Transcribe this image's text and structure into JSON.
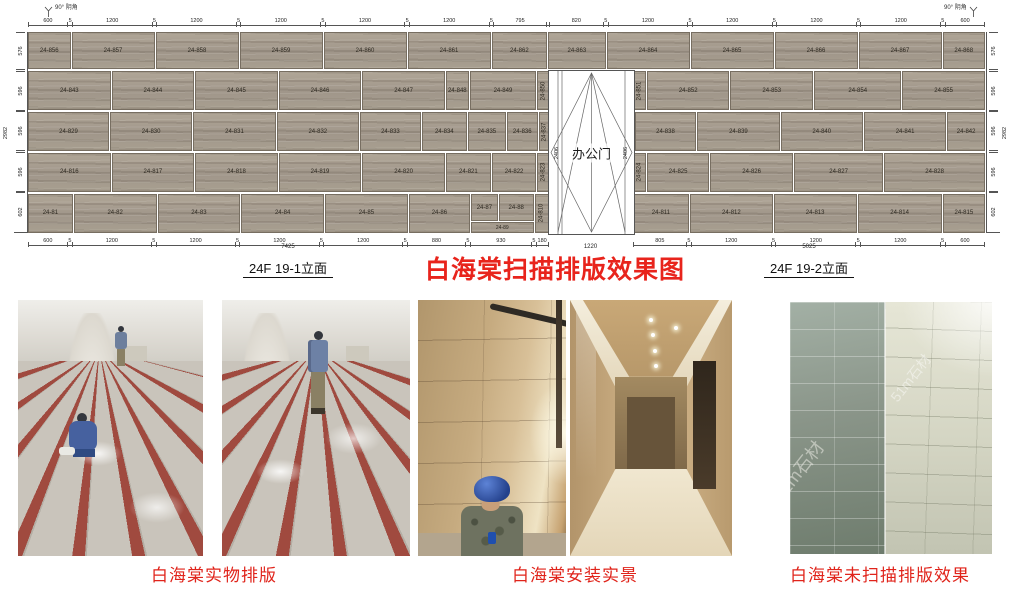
{
  "colors": {
    "accent_red": "#e8241c",
    "stone": "#a89e90"
  },
  "elevation": {
    "corner_note_left": "90° 阴角",
    "corner_note_right": "90° 阴角",
    "main_title": "白海棠扫描排版效果图",
    "label_left": "24F 19-1立面",
    "label_right": "24F 19-2立面",
    "total_left": "7425",
    "total_door": "1220",
    "total_right": "5025",
    "door": {
      "label": "办公门",
      "height_dim": "2406"
    },
    "top_dims": [
      {
        "v": "600",
        "w": 600
      },
      {
        "v": "5",
        "w": 70
      },
      {
        "v": "1200",
        "w": 1200
      },
      {
        "v": "5",
        "w": 70
      },
      {
        "v": "1200",
        "w": 1200
      },
      {
        "v": "5",
        "w": 70
      },
      {
        "v": "1200",
        "w": 1200
      },
      {
        "v": "5",
        "w": 70
      },
      {
        "v": "1200",
        "w": 1200
      },
      {
        "v": "5",
        "w": 70
      },
      {
        "v": "1200",
        "w": 1200
      },
      {
        "v": "5",
        "w": 70
      },
      {
        "v": "795",
        "w": 795
      },
      {
        "v": "",
        "w": 40
      },
      {
        "v": "820",
        "w": 820
      },
      {
        "v": "5",
        "w": 70
      },
      {
        "v": "1200",
        "w": 1200
      },
      {
        "v": "5",
        "w": 70
      },
      {
        "v": "1200",
        "w": 1200
      },
      {
        "v": "5",
        "w": 70
      },
      {
        "v": "1200",
        "w": 1200
      },
      {
        "v": "5",
        "w": 70
      },
      {
        "v": "1200",
        "w": 1200
      },
      {
        "v": "5",
        "w": 70
      },
      {
        "v": "600",
        "w": 600
      }
    ],
    "bottom_dims_left": [
      {
        "v": "600",
        "w": 600
      },
      {
        "v": "5",
        "w": 70
      },
      {
        "v": "1200",
        "w": 1200
      },
      {
        "v": "5",
        "w": 70
      },
      {
        "v": "1200",
        "w": 1200
      },
      {
        "v": "5",
        "w": 70
      },
      {
        "v": "1200",
        "w": 1200
      },
      {
        "v": "5",
        "w": 70
      },
      {
        "v": "1200",
        "w": 1200
      },
      {
        "v": "5",
        "w": 70
      },
      {
        "v": "880",
        "w": 880
      },
      {
        "v": "5",
        "w": 70
      },
      {
        "v": "930",
        "w": 930
      },
      {
        "v": "5",
        "w": 70
      },
      {
        "v": "180",
        "w": 180
      }
    ],
    "bottom_dims_right": [
      {
        "v": "805",
        "w": 805
      },
      {
        "v": "5",
        "w": 70
      },
      {
        "v": "1200",
        "w": 1200
      },
      {
        "v": "5",
        "w": 70
      },
      {
        "v": "1200",
        "w": 1200
      },
      {
        "v": "5",
        "w": 70
      },
      {
        "v": "1200",
        "w": 1200
      },
      {
        "v": "5",
        "w": 70
      },
      {
        "v": "600",
        "w": 600
      }
    ],
    "left_dims": {
      "total": "2982",
      "segments": [
        {
          "v": "576",
          "w": 576
        },
        {
          "v": "4",
          "w": 20
        },
        {
          "v": "596",
          "w": 596
        },
        {
          "v": "4",
          "w": 20
        },
        {
          "v": "596",
          "w": 596
        },
        {
          "v": "4",
          "w": 20
        },
        {
          "v": "596",
          "w": 596
        },
        {
          "v": "4",
          "w": 20
        },
        {
          "v": "602",
          "w": 602
        }
      ]
    },
    "right_dims": {
      "total": "2982",
      "segments": [
        {
          "v": "576",
          "w": 576
        },
        {
          "v": "4",
          "w": 20
        },
        {
          "v": "596",
          "w": 596
        },
        {
          "v": "4",
          "w": 20
        },
        {
          "v": "596",
          "w": 596
        },
        {
          "v": "4",
          "w": 20
        },
        {
          "v": "596",
          "w": 596
        },
        {
          "v": "4",
          "w": 20
        },
        {
          "v": "602",
          "w": 602
        }
      ]
    },
    "rows": [
      {
        "h": 576,
        "cells": [
          {
            "t": "p",
            "label": "24-856",
            "w": 600
          },
          {
            "t": "p",
            "label": "24-857",
            "w": 1200
          },
          {
            "t": "p",
            "label": "24-858",
            "w": 1200
          },
          {
            "t": "p",
            "label": "24-859",
            "w": 1200
          },
          {
            "t": "p",
            "label": "24-860",
            "w": 1200
          },
          {
            "t": "p",
            "label": "24-861",
            "w": 1200
          },
          {
            "t": "p",
            "label": "24-862",
            "w": 795
          },
          {
            "t": "p",
            "label": "24-863",
            "w": 820
          },
          {
            "t": "p",
            "label": "24-864",
            "w": 1200
          },
          {
            "t": "p",
            "label": "24-865",
            "w": 1200
          },
          {
            "t": "p",
            "label": "24-866",
            "w": 1200
          },
          {
            "t": "p",
            "label": "24-867",
            "w": 1200
          },
          {
            "t": "p",
            "label": "24-868",
            "w": 600
          }
        ]
      },
      {
        "h": 596,
        "cells": [
          {
            "t": "p",
            "label": "24-843",
            "w": 1200
          },
          {
            "t": "p",
            "label": "24-844",
            "w": 1200
          },
          {
            "t": "p",
            "label": "24-845",
            "w": 1200
          },
          {
            "t": "p",
            "label": "24-846",
            "w": 1200
          },
          {
            "t": "p",
            "label": "24-847",
            "w": 1200
          },
          {
            "t": "p",
            "label": "24-848",
            "w": 310
          },
          {
            "t": "p",
            "label": "24-849",
            "w": 960
          },
          {
            "t": "p",
            "label": "24-850",
            "w": 155,
            "narrow": true
          },
          {
            "t": "gap",
            "w": 1220
          },
          {
            "t": "p",
            "label": "24-851",
            "w": 155,
            "narrow": true
          },
          {
            "t": "p",
            "label": "24-852",
            "w": 1200
          },
          {
            "t": "p",
            "label": "24-853",
            "w": 1200
          },
          {
            "t": "p",
            "label": "24-854",
            "w": 1270
          },
          {
            "t": "p",
            "label": "24-855",
            "w": 1200
          }
        ]
      },
      {
        "h": 596,
        "cells": [
          {
            "t": "p",
            "label": "24-829",
            "w": 1180
          },
          {
            "t": "p",
            "label": "24-830",
            "w": 1200
          },
          {
            "t": "p",
            "label": "24-831",
            "w": 1200
          },
          {
            "t": "p",
            "label": "24-832",
            "w": 1200
          },
          {
            "t": "p",
            "label": "24-833",
            "w": 880
          },
          {
            "t": "p",
            "label": "24-834",
            "w": 640
          },
          {
            "t": "p",
            "label": "24-835",
            "w": 540
          },
          {
            "t": "p",
            "label": "24-836",
            "w": 430
          },
          {
            "t": "p",
            "label": "24-837",
            "w": 155,
            "narrow": true
          },
          {
            "t": "gap",
            "w": 1220
          },
          {
            "t": "p",
            "label": "24-838",
            "w": 890
          },
          {
            "t": "p",
            "label": "24-839",
            "w": 1200
          },
          {
            "t": "p",
            "label": "24-840",
            "w": 1200
          },
          {
            "t": "p",
            "label": "24-841",
            "w": 1200
          },
          {
            "t": "p",
            "label": "24-842",
            "w": 535
          }
        ]
      },
      {
        "h": 596,
        "cells": [
          {
            "t": "p",
            "label": "24-816",
            "w": 1200
          },
          {
            "t": "p",
            "label": "24-817",
            "w": 1200
          },
          {
            "t": "p",
            "label": "24-818",
            "w": 1200
          },
          {
            "t": "p",
            "label": "24-819",
            "w": 1200
          },
          {
            "t": "p",
            "label": "24-820",
            "w": 1200
          },
          {
            "t": "p",
            "label": "24-821",
            "w": 640
          },
          {
            "t": "p",
            "label": "24-822",
            "w": 630
          },
          {
            "t": "p",
            "label": "24-823",
            "w": 155,
            "narrow": true
          },
          {
            "t": "gap",
            "w": 1220
          },
          {
            "t": "p",
            "label": "24-824",
            "w": 155,
            "narrow": true
          },
          {
            "t": "p",
            "label": "24-825",
            "w": 900
          },
          {
            "t": "p",
            "label": "24-826",
            "w": 1200
          },
          {
            "t": "p",
            "label": "24-827",
            "w": 1300
          },
          {
            "t": "p",
            "label": "24-828",
            "w": 1470
          }
        ]
      },
      {
        "h": 602,
        "cells": [
          {
            "t": "p",
            "label": "24-81",
            "w": 635
          },
          {
            "t": "p",
            "label": "24-82",
            "w": 1200
          },
          {
            "t": "p",
            "label": "24-83",
            "w": 1200
          },
          {
            "t": "p",
            "label": "24-84",
            "w": 1200
          },
          {
            "t": "p",
            "label": "24-85",
            "w": 1200
          },
          {
            "t": "p",
            "label": "24-86",
            "w": 880
          },
          {
            "t": "cluster",
            "w": 930,
            "top": [
              {
                "label": "24-87",
                "w": 400
              },
              {
                "label": "24-88",
                "w": 530
              }
            ],
            "bottom": {
              "label": "24-89"
            }
          },
          {
            "t": "p",
            "label": "24-810",
            "w": 180,
            "narrow": true
          },
          {
            "t": "gap",
            "w": 1220
          },
          {
            "t": "p",
            "label": "24-811",
            "w": 805
          },
          {
            "t": "p",
            "label": "24-812",
            "w": 1200
          },
          {
            "t": "p",
            "label": "24-813",
            "w": 1200
          },
          {
            "t": "p",
            "label": "24-814",
            "w": 1220
          },
          {
            "t": "p",
            "label": "24-815",
            "w": 600
          }
        ]
      }
    ]
  },
  "photos": {
    "watermark": "51m石材",
    "captions": [
      {
        "text": "白海棠实物排版"
      },
      {
        "text": "白海棠安装实景"
      },
      {
        "text": "白海棠未扫描排版效果"
      }
    ]
  }
}
